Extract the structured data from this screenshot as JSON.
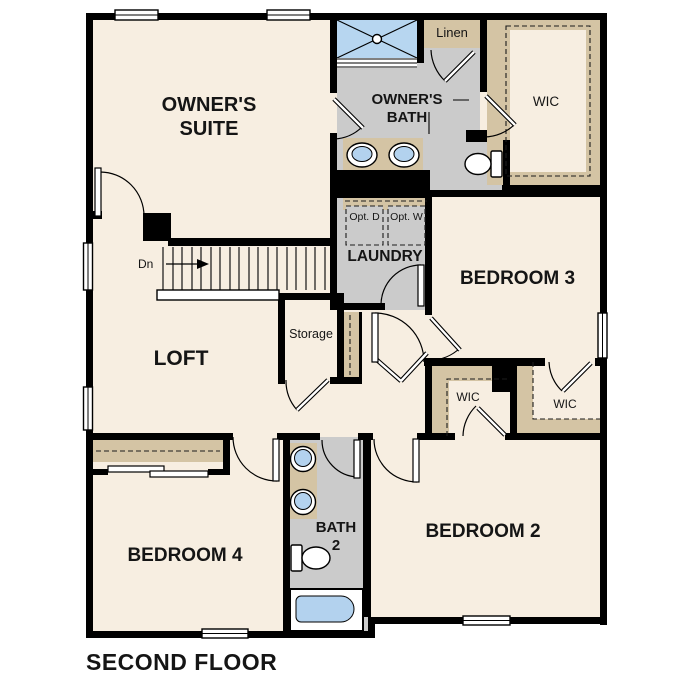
{
  "title": "SECOND FLOOR",
  "labels": {
    "owners_suite": "OWNER'S SUITE",
    "owners_bath": "OWNER'S BATH",
    "linen": "Linen",
    "wic_owner": "WIC",
    "laundry": "LAUNDRY",
    "opt_dryer": "Opt. D",
    "opt_washer": "Opt. W",
    "bedroom3": "BEDROOM 3",
    "loft": "LOFT",
    "storage": "Storage",
    "wic_left": "WIC",
    "wic_right": "WIC",
    "bedroom4": "BEDROOM 4",
    "bath2": "BATH 2",
    "bedroom2": "BEDROOM 2",
    "stairs_dn": "Dn"
  },
  "colors": {
    "floor": "#f7eee1",
    "bath_floor": "#cbcbcb",
    "closet": "#d4c4a4",
    "fixture_blue": "#b3d2ee",
    "shower_blue": "#b7d6f0",
    "wall": "#000000"
  },
  "icons": {
    "shower": "shower-pan-icon",
    "sinks": "sink-basin-icon",
    "toilets": "toilet-icon",
    "tub": "bathtub-icon",
    "stairs": "stair-treads-icon",
    "arrow": "down-direction-arrow-icon"
  }
}
